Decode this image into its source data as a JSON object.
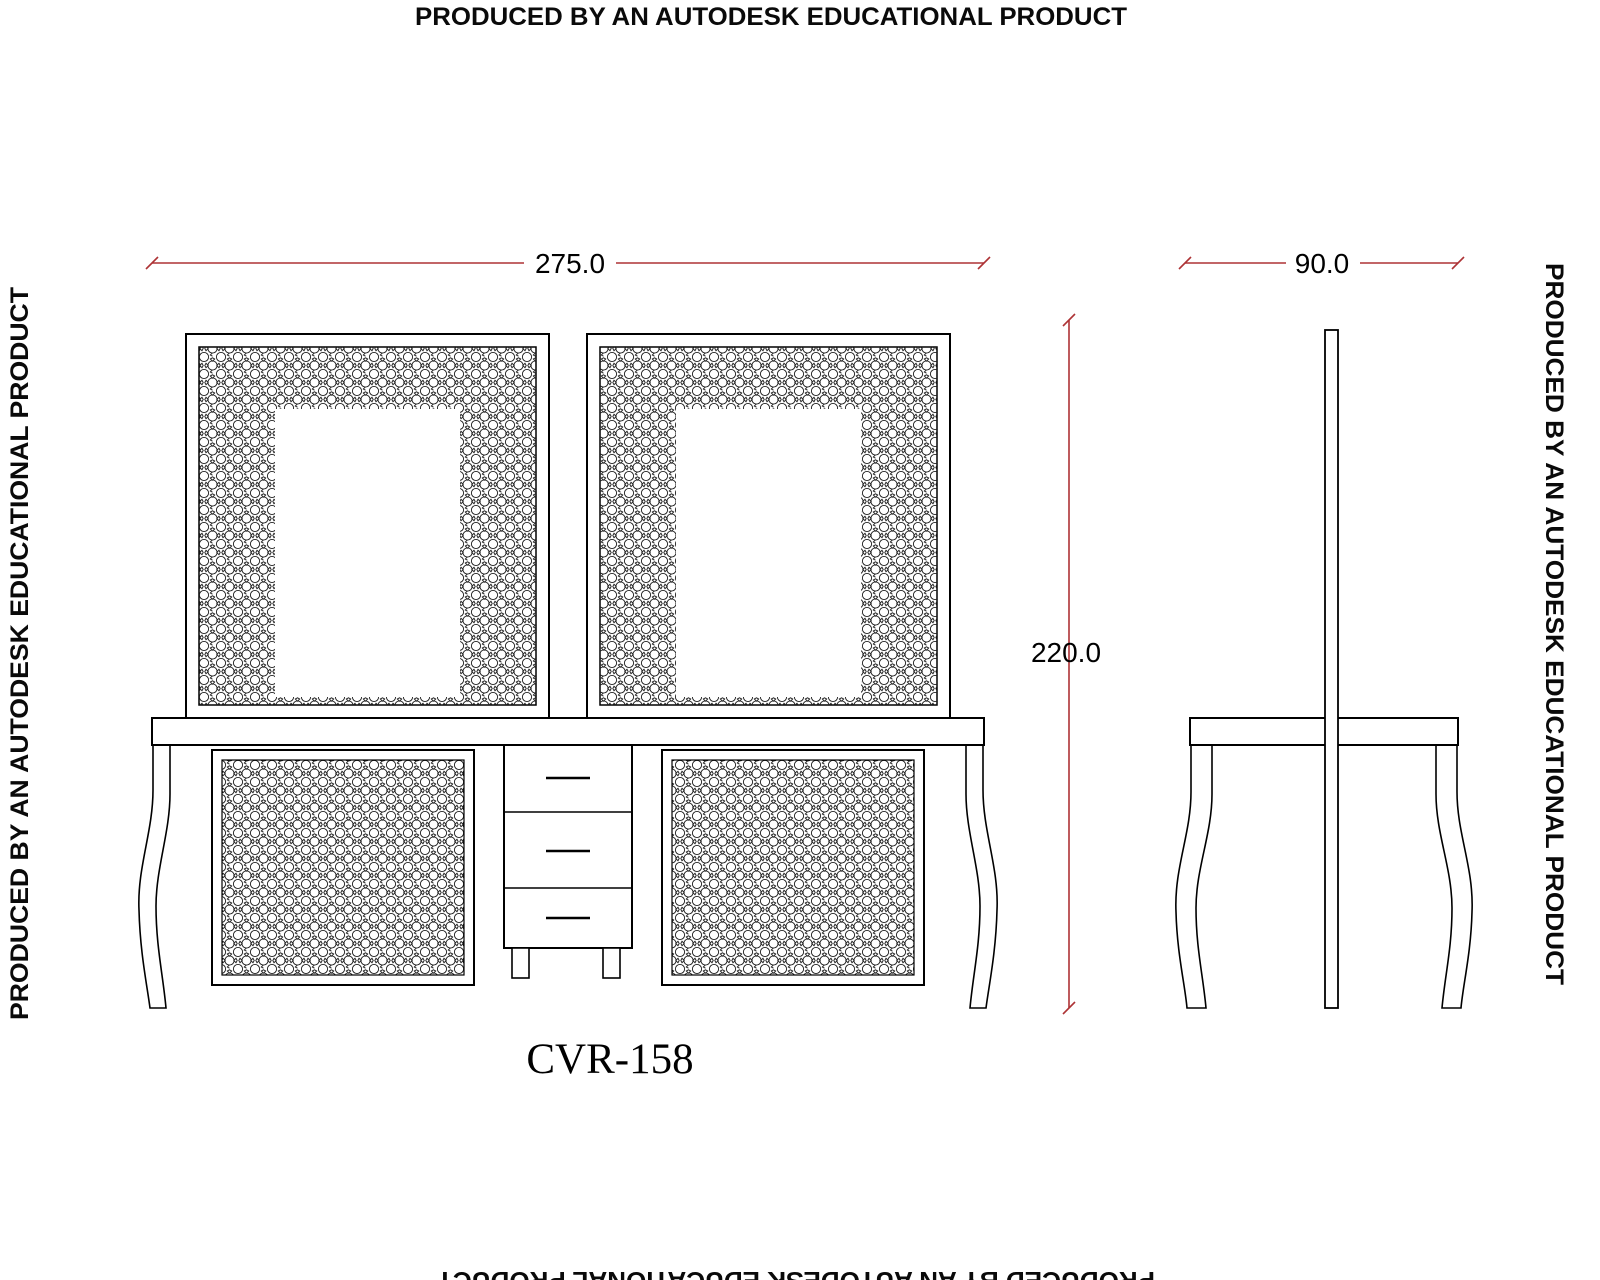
{
  "watermarks": {
    "top": "PRODUCED BY AN AUTODESK EDUCATIONAL PRODUCT",
    "bottom": "PRODUCED BY AN AUTODESK EDUCATIONAL PRODUCT",
    "left": "PRODUCED BY AN AUTODESK EDUCATIONAL PRODUCT",
    "right": "PRODUCED BY AN AUTODESK EDUCATIONAL PRODUCT"
  },
  "drawing": {
    "title": "CVR-158",
    "type_note": "CAD elevation drawing of a dressing table with two mirrors: front view and side view",
    "dimensions": {
      "width": "275.0",
      "depth": "90.0",
      "height": "220.0"
    }
  },
  "colors": {
    "dimension_line": "#ad3235",
    "outline": "#000000",
    "background": "#ffffff"
  }
}
